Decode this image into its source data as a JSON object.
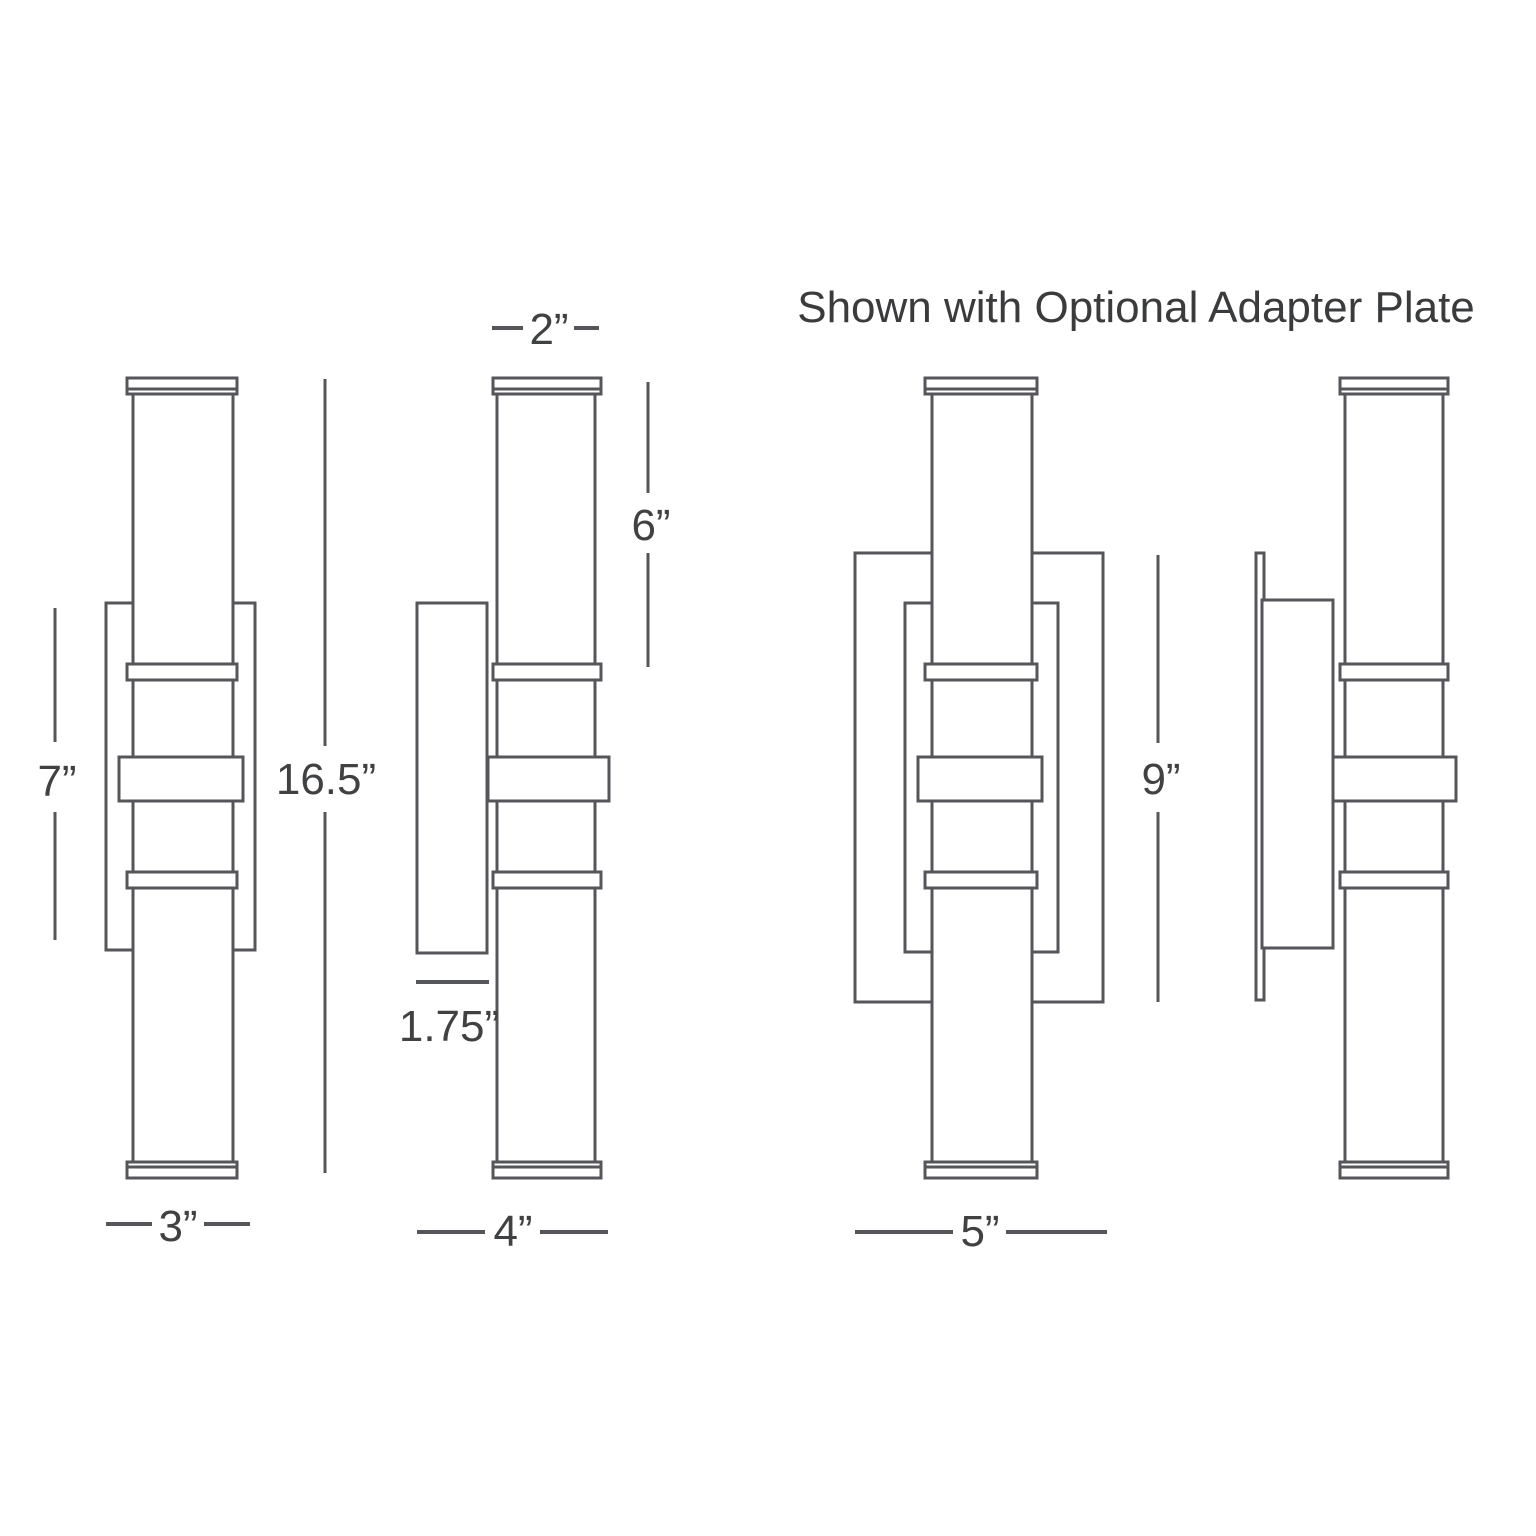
{
  "title": "Shown with Optional Adapter Plate",
  "line_color": "#54565a",
  "label_color": "#3f4143",
  "views": {
    "front": {
      "labels": {
        "backplate_height": "7”",
        "overall_height": "16.5”",
        "overall_width": "3”"
      }
    },
    "side": {
      "labels": {
        "shade_width": "2”",
        "upper_shade_length": "6”",
        "backplate_depth": "1.75”",
        "overall_depth": "4”"
      }
    },
    "adapter_front": {
      "labels": {
        "adapter_plate_height": "9”",
        "adapter_plate_width": "5”"
      }
    }
  }
}
